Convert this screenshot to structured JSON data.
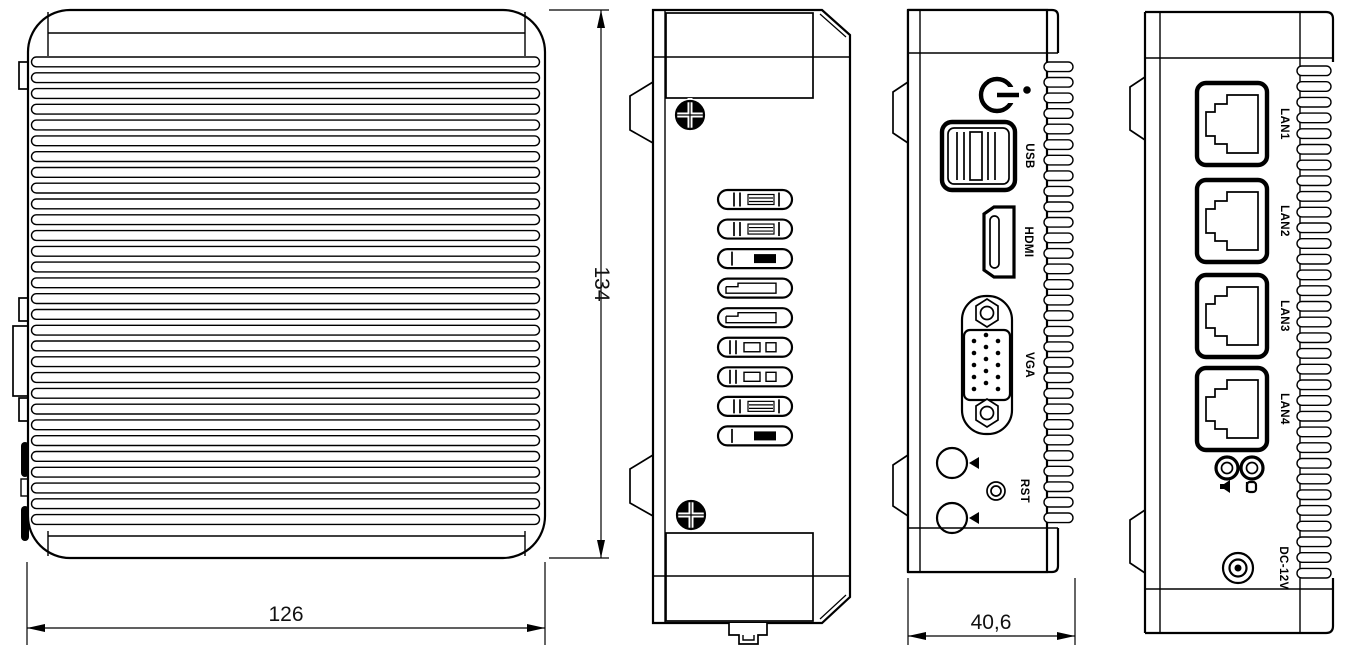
{
  "drawing": {
    "background": "#ffffff",
    "line_color": "#000000",
    "dimensions": {
      "width": "126",
      "height": "134",
      "depth": "40,6"
    },
    "top_view": {
      "fin_count": 30
    },
    "side_view": {
      "screw_count": 2,
      "vent_slots": [
        "hatch",
        "hatch",
        "fill",
        "step",
        "step",
        "box",
        "box",
        "hatch",
        "fill"
      ]
    },
    "front_view": {
      "usb_label": "USB",
      "hdmi_label": "HDMI",
      "vga_label": "VGA",
      "reset_label": "RST",
      "fin_teeth": 30
    },
    "rear_view": {
      "lan_labels": [
        "LAN1",
        "LAN2",
        "LAN3",
        "LAN4"
      ],
      "dc_label": "DC-12V",
      "fin_teeth": 33
    }
  }
}
